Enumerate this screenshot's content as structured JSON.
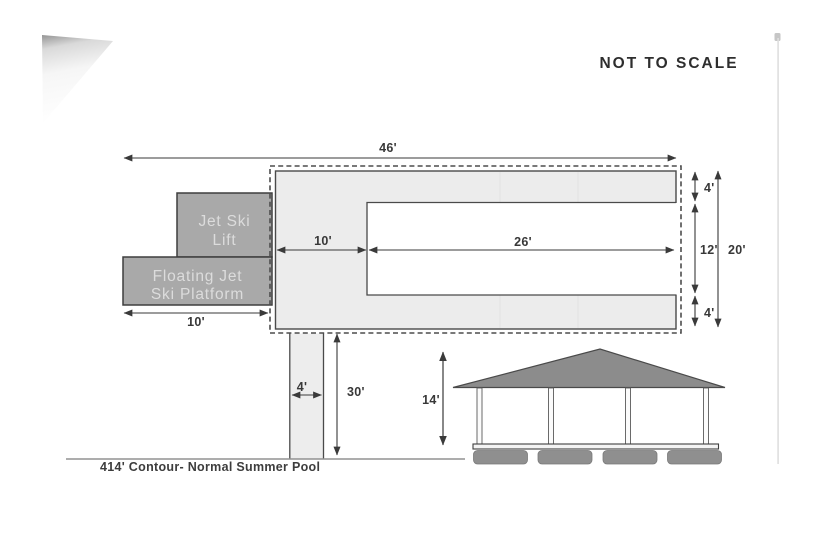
{
  "note": "NOT TO SCALE",
  "structures": {
    "jet_ski_lift": {
      "line1": "Jet Ski",
      "line2": "Lift"
    },
    "floating_platform": {
      "line1": "Floating Jet",
      "line2": "Ski Platform"
    }
  },
  "dimensions": {
    "overall_width": "46'",
    "deck_to_slip": "10'",
    "slip_length": "26'",
    "finger_top": "4'",
    "slip_width": "12'",
    "dock_depth": "20'",
    "platform_length": "10'",
    "finger_bottom": "4'",
    "walkway_width": "4'",
    "walkway_length": "30'",
    "boathouse_height": "14'"
  },
  "baseline": {
    "contour_label": "414' Contour- Normal Summer Pool"
  }
}
